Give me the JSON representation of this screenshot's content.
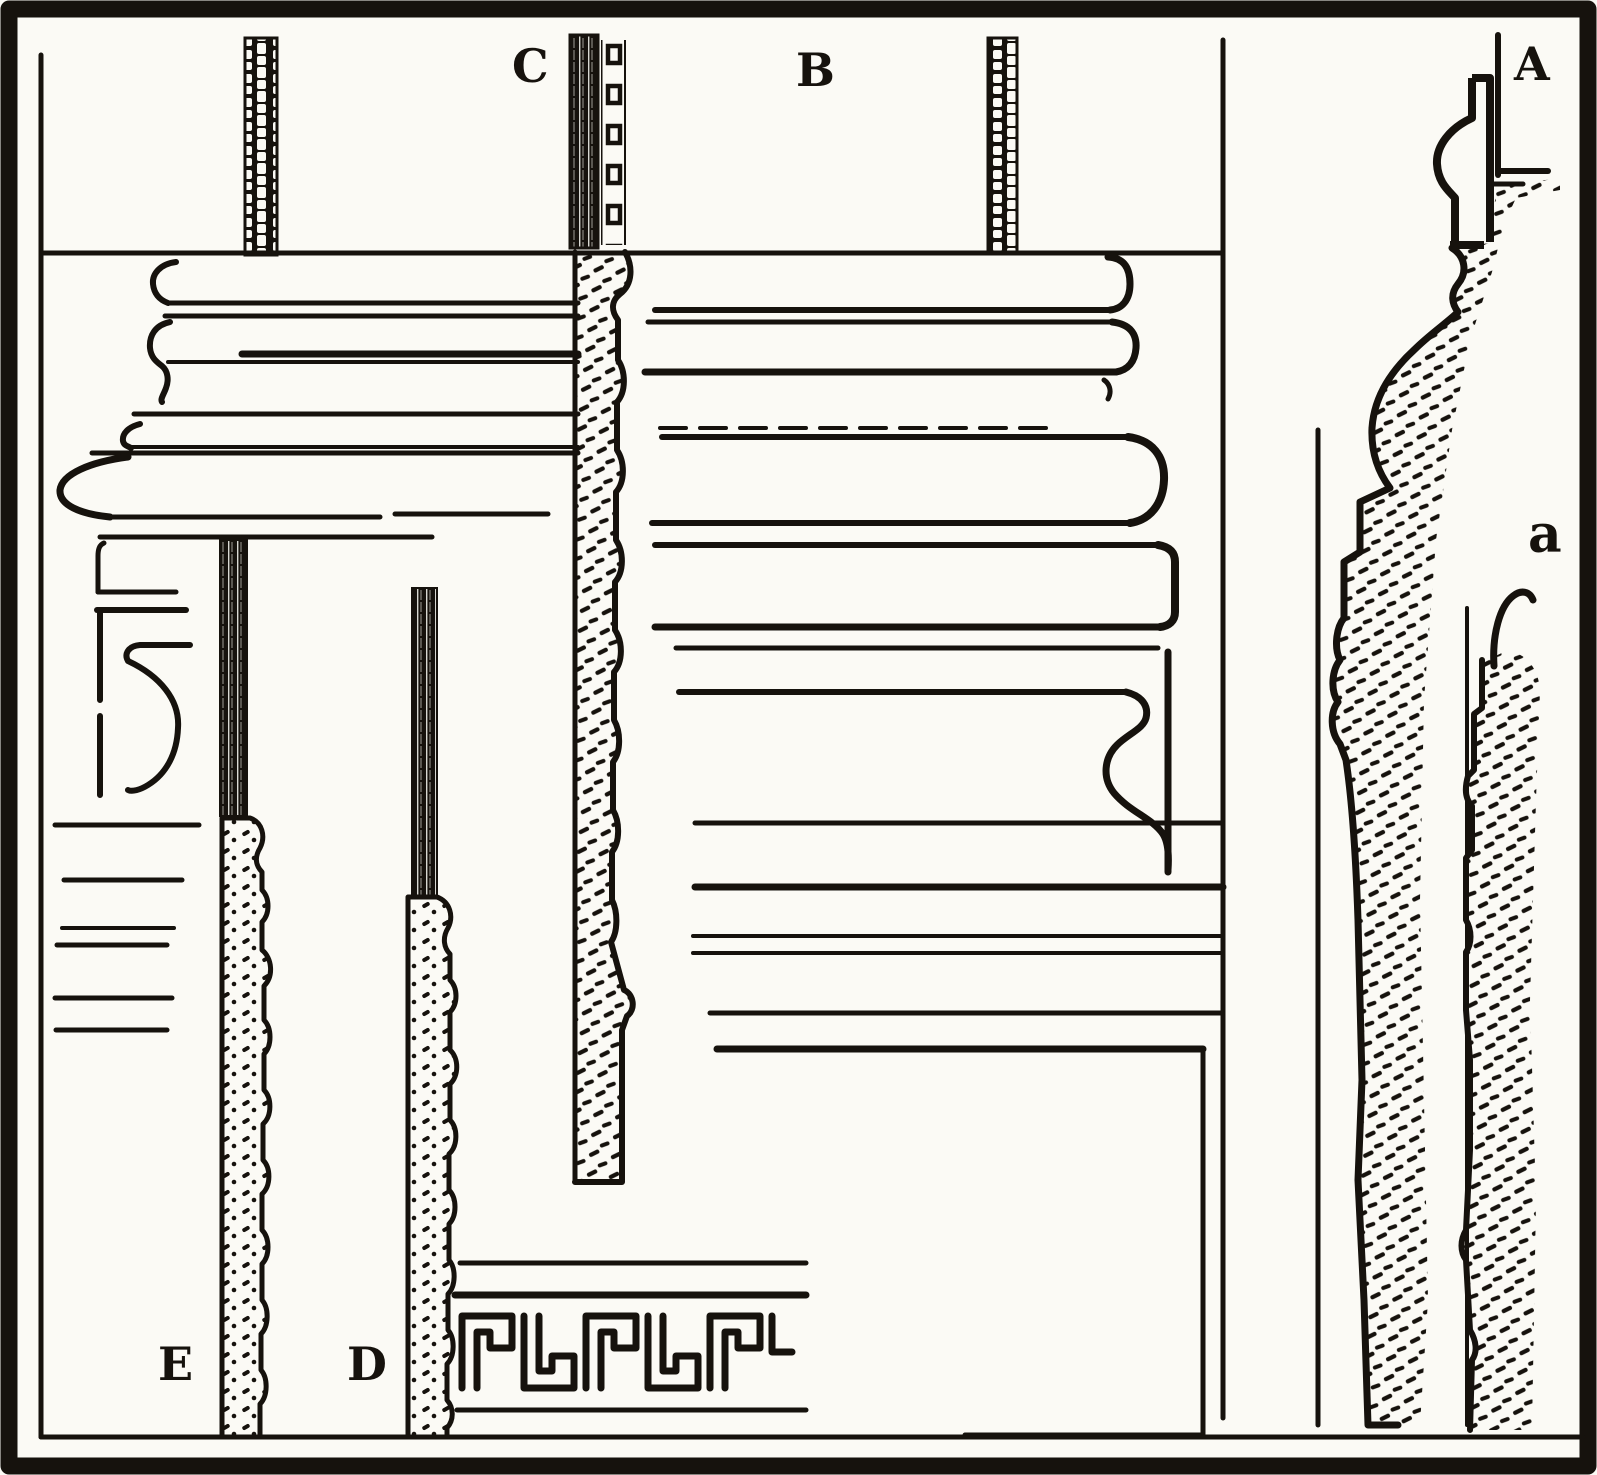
{
  "figure": {
    "kind": "engraved-plate-of-moulding-sections",
    "paper_color": "#fbfaf5",
    "ink_color": "#16120d",
    "labels": {
      "A": "A",
      "B": "B",
      "C": "C",
      "D": "D",
      "E": "E",
      "a_lower": "a"
    },
    "sections": {
      "A": "wall profile with ball-and-stem moulding, stippled plaster section",
      "B": "stacked cornice bands with rounded ends and cyma bracket",
      "C": "lath strip over long stippled moulding section",
      "D": "lath strip with stippled stepped section",
      "E": "lath strip with stippled stepped section",
      "a_lower": "secondary stippled wall section",
      "ornament": "greek-key meander band at bottom"
    }
  }
}
